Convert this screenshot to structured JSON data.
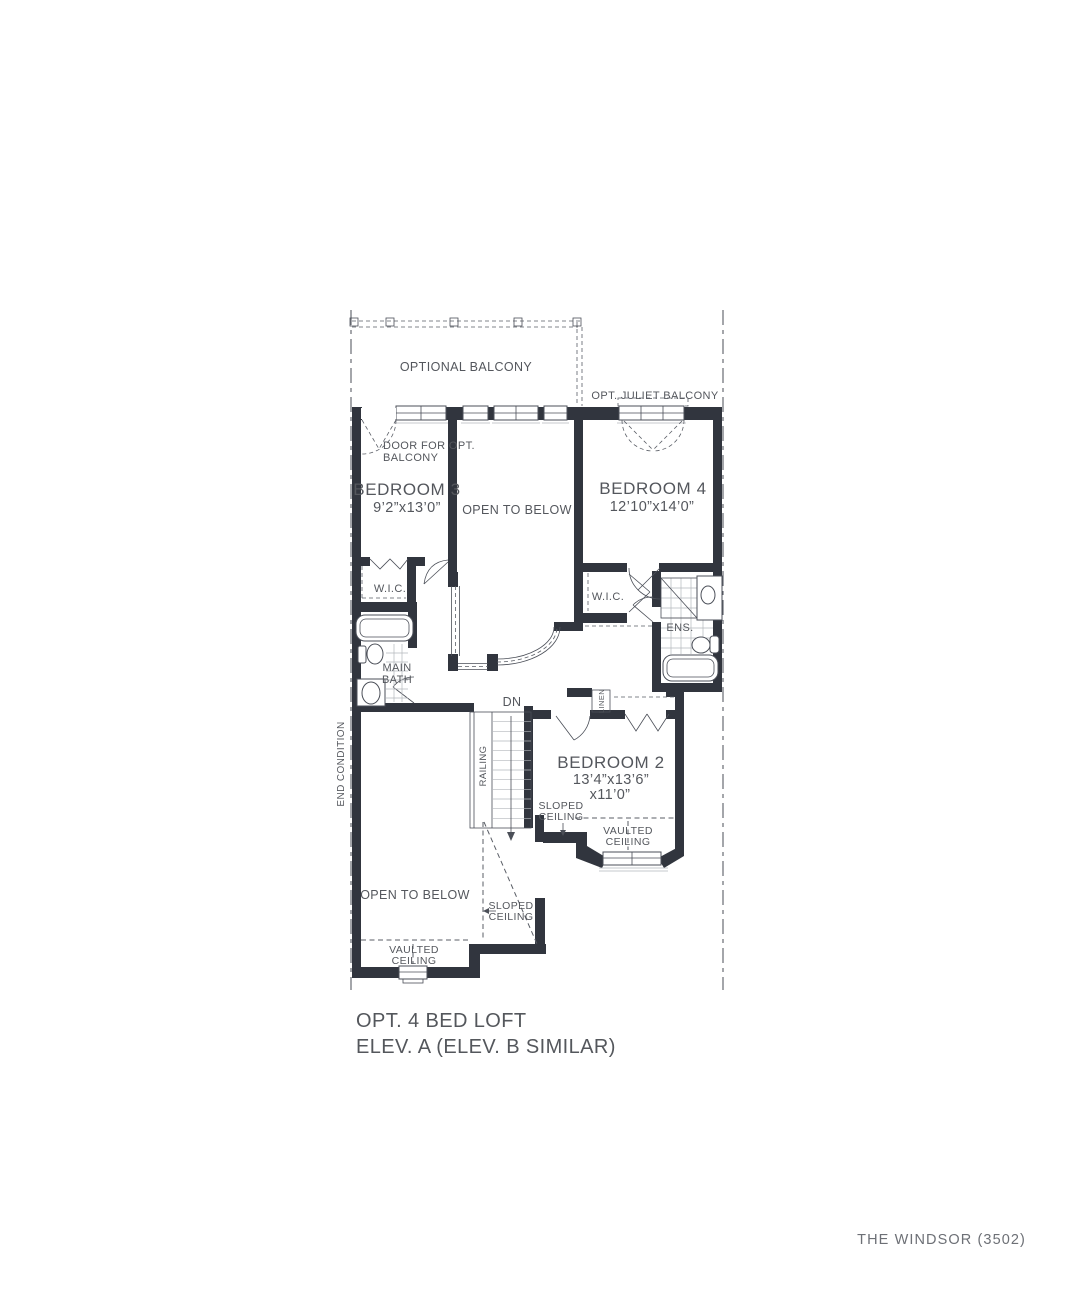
{
  "document": {
    "title_line1": "OPT. 4 BED LOFT",
    "title_line2": "ELEV. A (ELEV. B SIMILAR)",
    "footer": "THE WINDSOR (3502)"
  },
  "colors": {
    "wall": "#31353e",
    "line": "#4b4f58",
    "text": "#54575d",
    "muted": "#6d7076",
    "grid": "#b4b7bc",
    "dash": "#5a5e66"
  },
  "floorplan": {
    "site": {
      "end_condition": "END CONDITION",
      "optional_balcony": "OPTIONAL BALCONY",
      "juliet_balcony": "OPT. JULIET BALCONY"
    },
    "rooms": {
      "bedroom3": {
        "name": "BEDROOM 3",
        "dims": "9’2”x13’0”"
      },
      "bedroom4": {
        "name": "BEDROOM 4",
        "dims": "12’10”x14’0”"
      },
      "bedroom2": {
        "name": "BEDROOM 2",
        "dims_line1": "13’4”x13’6”",
        "dims_line2": "x11’0”"
      },
      "open_to_below_center": "OPEN TO BELOW",
      "open_to_below_lower": "OPEN TO BELOW",
      "wic": "W.I.C.",
      "main_bath_line1": "MAIN",
      "main_bath_line2": "BATH",
      "ensuite": "ENS.",
      "linen": "LINEN"
    },
    "annotations": {
      "door_opt_balcony_line1": "DOOR FOR OPT.",
      "door_opt_balcony_line2": "BALCONY",
      "dn": "DN",
      "railing": "RAILING",
      "sloped_word": "SLOPED",
      "vaulted_word": "VAULTED",
      "ceiling_word": "CEILING"
    }
  }
}
